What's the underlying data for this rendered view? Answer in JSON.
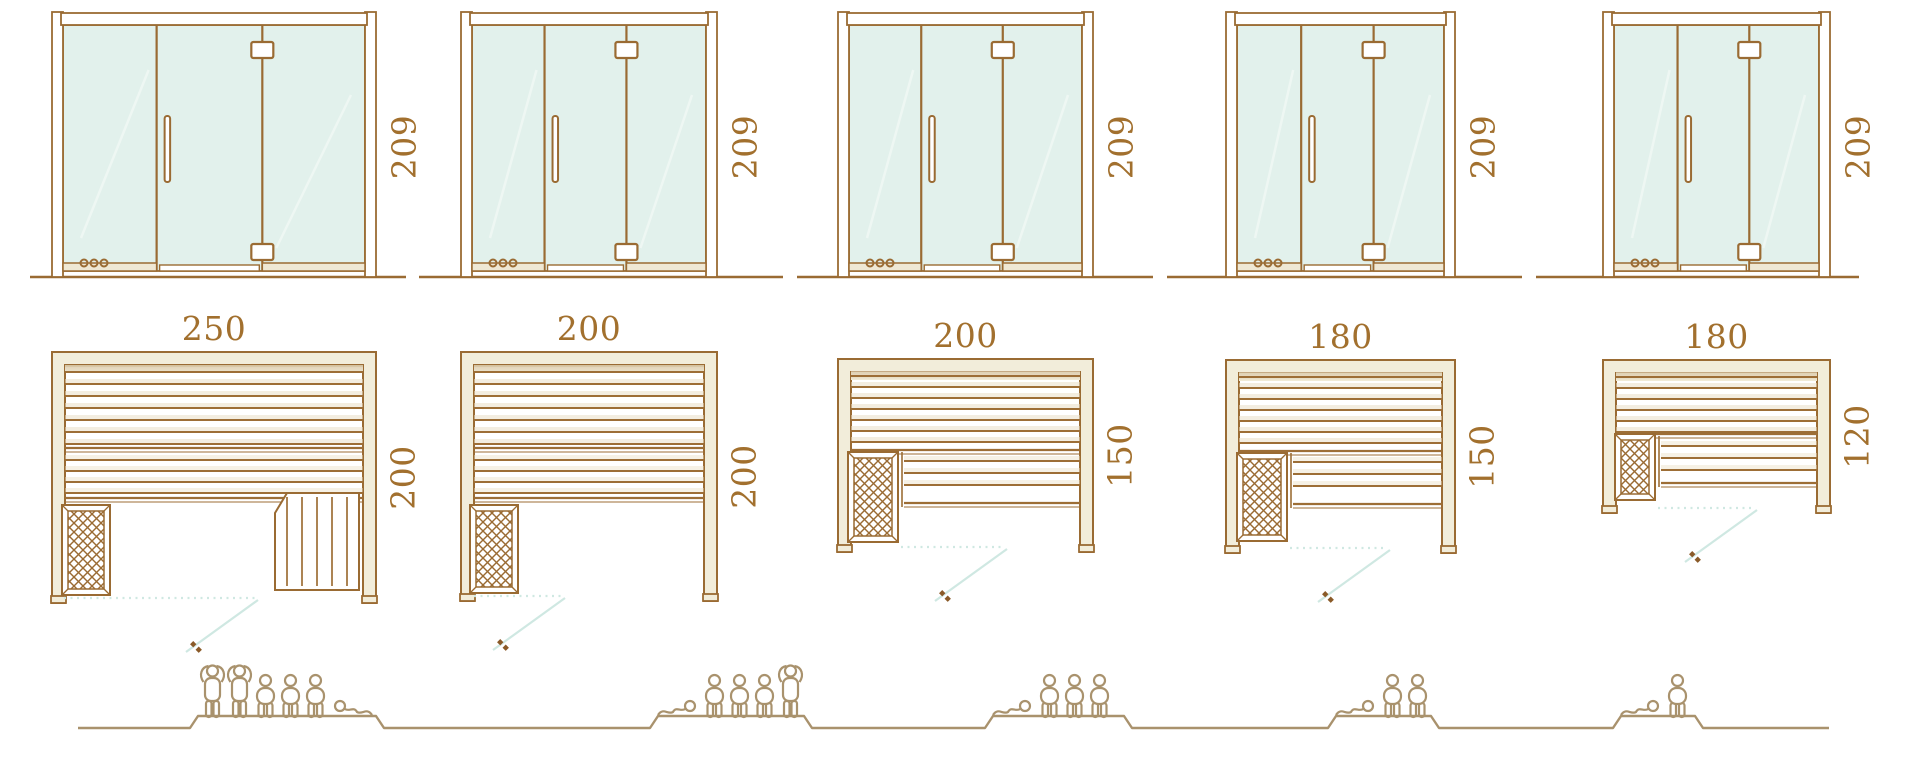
{
  "colors": {
    "line": "#9a6b33",
    "dimension_text": "#a2702e",
    "glass": "#e2f1ec",
    "glass_reflection": "#eef7f3",
    "wall_fill": "#f2edda",
    "wall_shade": "#d2bf9b",
    "slat": "#9d6e36",
    "slat_shadow": "#eadfc6",
    "door_swing": "#cfe8e2",
    "figure": "#a9926d",
    "handle_dot": "#8a5a28",
    "rail_fill": "#efe8d4"
  },
  "models": [
    {
      "id": "sauna-250x200",
      "elevation_height_label": "209",
      "plan_width_label": "250",
      "plan_depth_label": "200",
      "dimensions_cm": {
        "width": 250,
        "depth": 200,
        "height": 209
      },
      "capacity": {
        "standing": 2,
        "sitting": 3,
        "lying": 1,
        "total": 6
      }
    },
    {
      "id": "sauna-200x200",
      "elevation_height_label": "209",
      "plan_width_label": "200",
      "plan_depth_label": "200",
      "dimensions_cm": {
        "width": 200,
        "depth": 200,
        "height": 209
      },
      "capacity": {
        "standing": 1,
        "sitting": 3,
        "lying": 1,
        "total": 5
      }
    },
    {
      "id": "sauna-200x150",
      "elevation_height_label": "209",
      "plan_width_label": "200",
      "plan_depth_label": "150",
      "dimensions_cm": {
        "width": 200,
        "depth": 150,
        "height": 209
      },
      "capacity": {
        "standing": 0,
        "sitting": 3,
        "lying": 1,
        "total": 4
      }
    },
    {
      "id": "sauna-180x150",
      "elevation_height_label": "209",
      "plan_width_label": "180",
      "plan_depth_label": "150",
      "dimensions_cm": {
        "width": 180,
        "depth": 150,
        "height": 209
      },
      "capacity": {
        "standing": 0,
        "sitting": 2,
        "lying": 1,
        "total": 3
      }
    },
    {
      "id": "sauna-180x120",
      "elevation_height_label": "209",
      "plan_width_label": "180",
      "plan_depth_label": "120",
      "dimensions_cm": {
        "width": 180,
        "depth": 120,
        "height": 209
      },
      "capacity": {
        "standing": 0,
        "sitting": 1,
        "lying": 1,
        "total": 2
      }
    }
  ]
}
